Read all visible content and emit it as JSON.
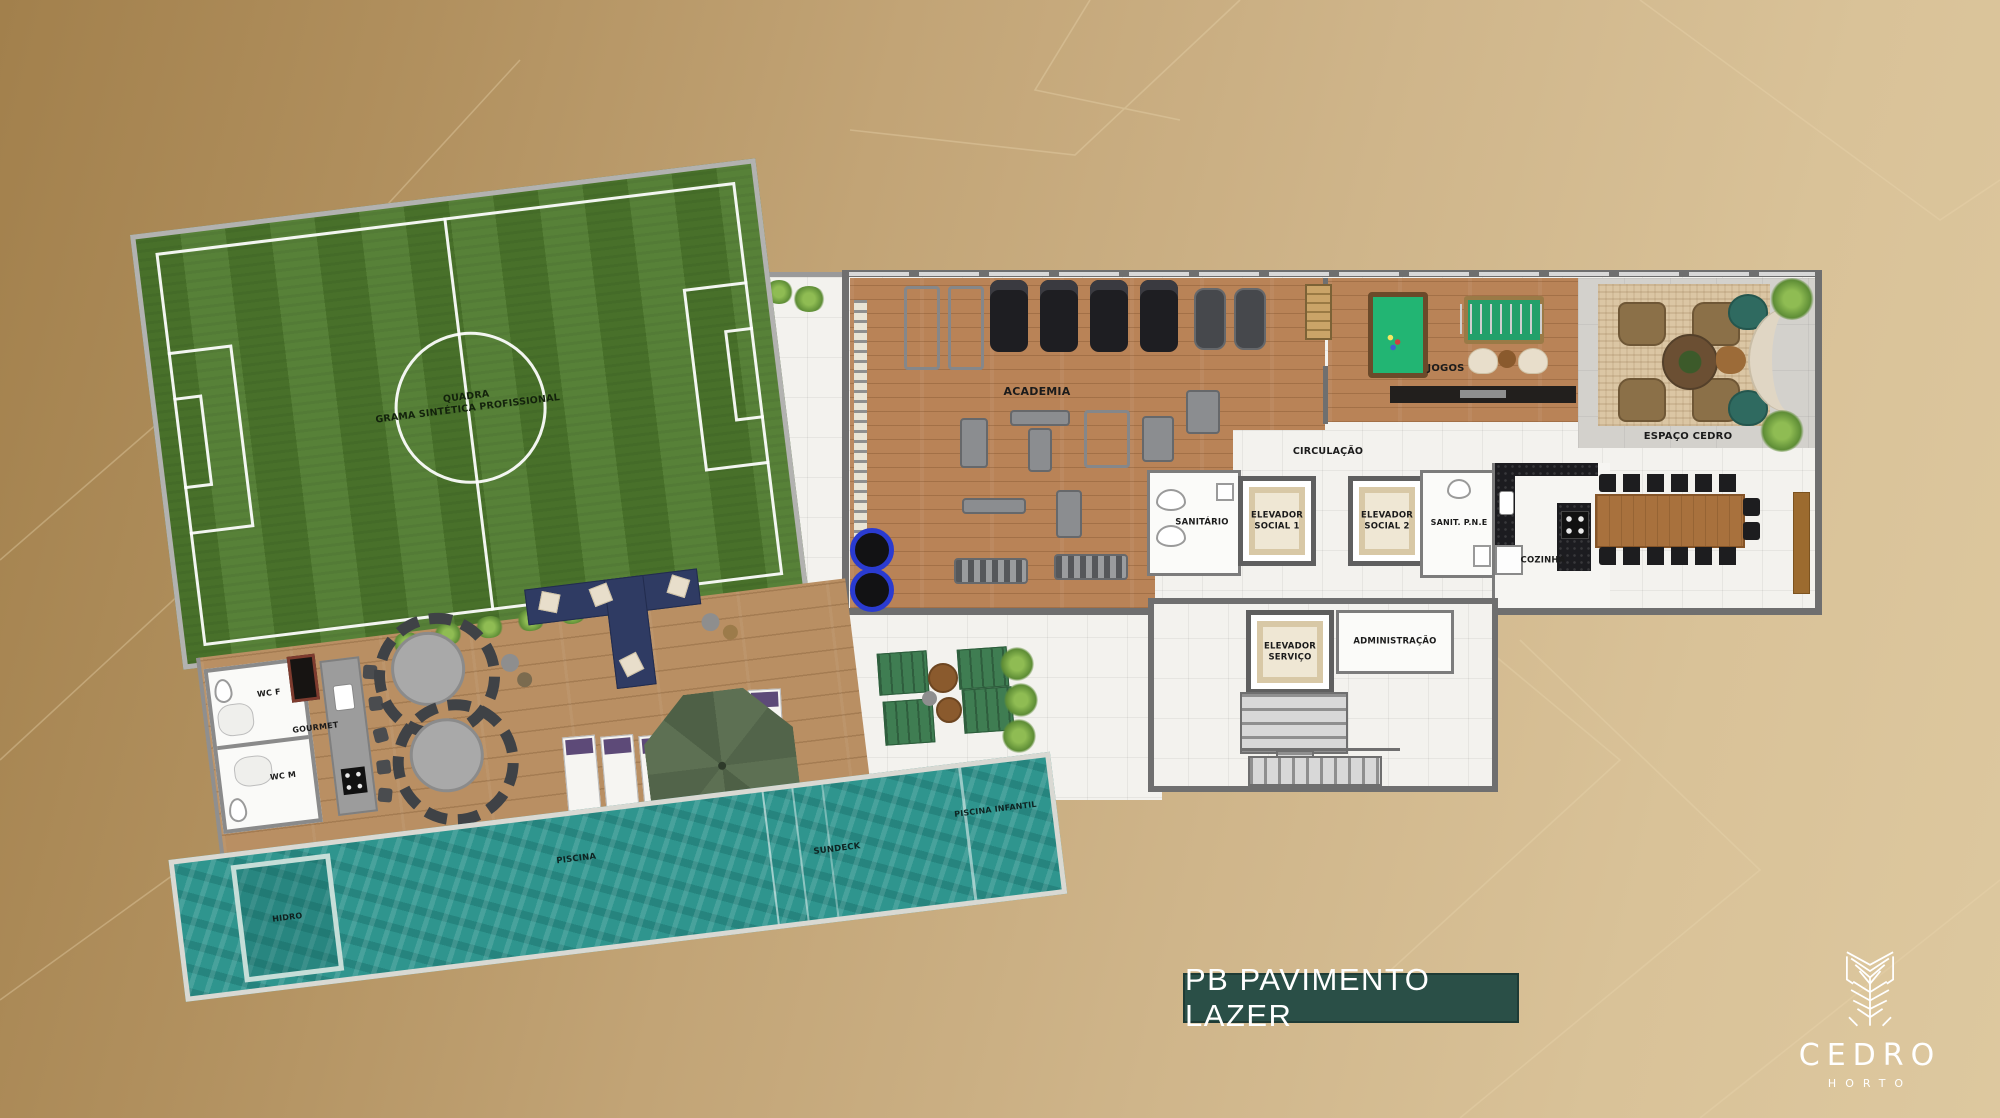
{
  "title_bar": {
    "text": "PB PAVIMENTO LAZER"
  },
  "brand": {
    "name": "CEDRO",
    "subtitle": "HORTO",
    "emblem": "cedro-leaf-emblem"
  },
  "colors": {
    "background_gold": "#c2a476",
    "title_bar_bg": "#2a4f47",
    "pool_water": "#2f958e",
    "grass_green": "#4e7a2d",
    "deck_wood": "#b98f63",
    "indoor_wood": "#b98357",
    "wall_gray": "#6f6f6f",
    "rug_beige": "#dbc6a4",
    "logo_white": "#ffffff"
  },
  "plan": {
    "quadra": [
      "QUADRA",
      "GRAMA SINTÉTICA PROFISSIONAL"
    ],
    "labels": {
      "academia": "ACADEMIA",
      "jogos": "JOGOS",
      "espaco_cedro": "ESPAÇO CEDRO",
      "circulacao": "CIRCULAÇÃO",
      "sanitario": "SANITÁRIO",
      "elevador_social_1": [
        "ELEVADOR",
        "SOCIAL 1"
      ],
      "elevador_social_2": [
        "ELEVADOR",
        "SOCIAL 2"
      ],
      "sanit_pne": "SANIT. P.N.E",
      "cozinha": "COZINHA",
      "elevador_servico": [
        "ELEVADOR",
        "SERVIÇO"
      ],
      "administracao": "ADMINISTRAÇÃO",
      "gourmet": "GOURMET",
      "wc_f": "WC F",
      "wc_m": "WC M",
      "piscina": "PISCINA",
      "hidro": "HIDRO",
      "sundeck": "SUNDECK",
      "piscina_infantil": "PISCINA INFANTIL"
    }
  }
}
